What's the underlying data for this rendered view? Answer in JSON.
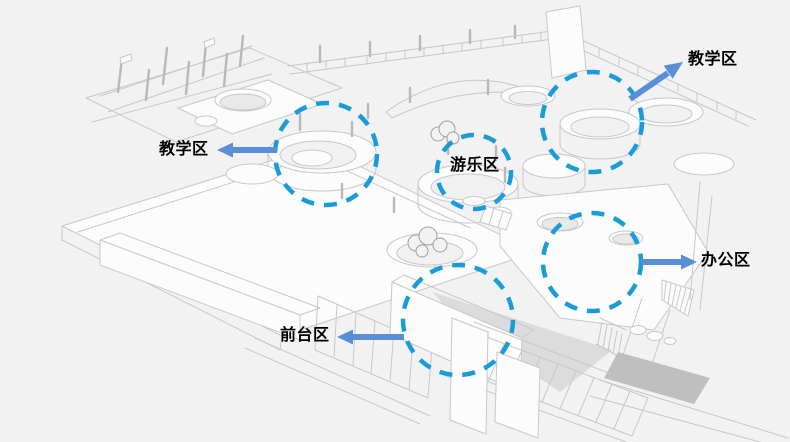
{
  "zones": [
    {
      "id": "teaching-right",
      "label": "教学区",
      "arrow_direction": "up-right"
    },
    {
      "id": "teaching-left",
      "label": "教学区",
      "arrow_direction": "left"
    },
    {
      "id": "play",
      "label": "游乐区",
      "arrow_direction": "none"
    },
    {
      "id": "office",
      "label": "办公区",
      "arrow_direction": "right"
    },
    {
      "id": "reception",
      "label": "前台区",
      "arrow_direction": "left"
    }
  ],
  "colors": {
    "highlight_circle": "#1a9cd8",
    "arrow": "#5b8fd5",
    "label_text": "#000000",
    "background": "#f2f2f2",
    "drawing_line": "#c8c8c8"
  }
}
